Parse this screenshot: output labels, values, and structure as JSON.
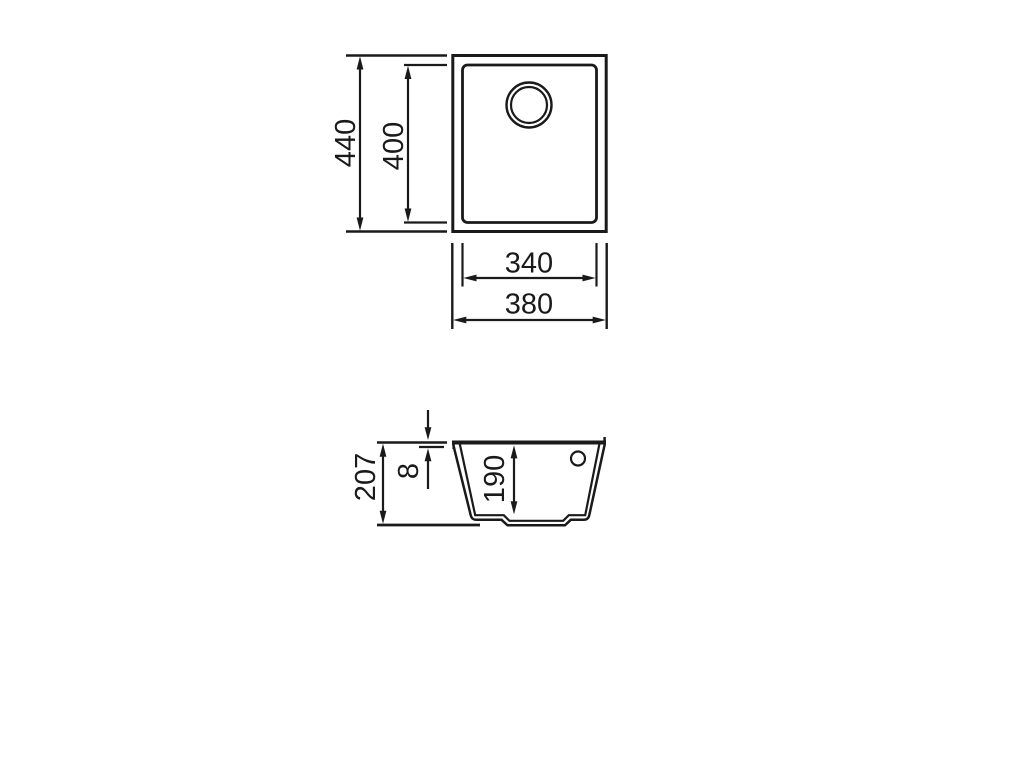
{
  "page": {
    "background": "#ffffff",
    "line_color": "#1a1a1a"
  },
  "top_view": {
    "outer_height": "440",
    "inner_height": "400",
    "inner_width": "340",
    "outer_width": "380"
  },
  "section_view": {
    "overall_height": "207",
    "rim_thickness": "8",
    "bowl_depth": "190"
  }
}
